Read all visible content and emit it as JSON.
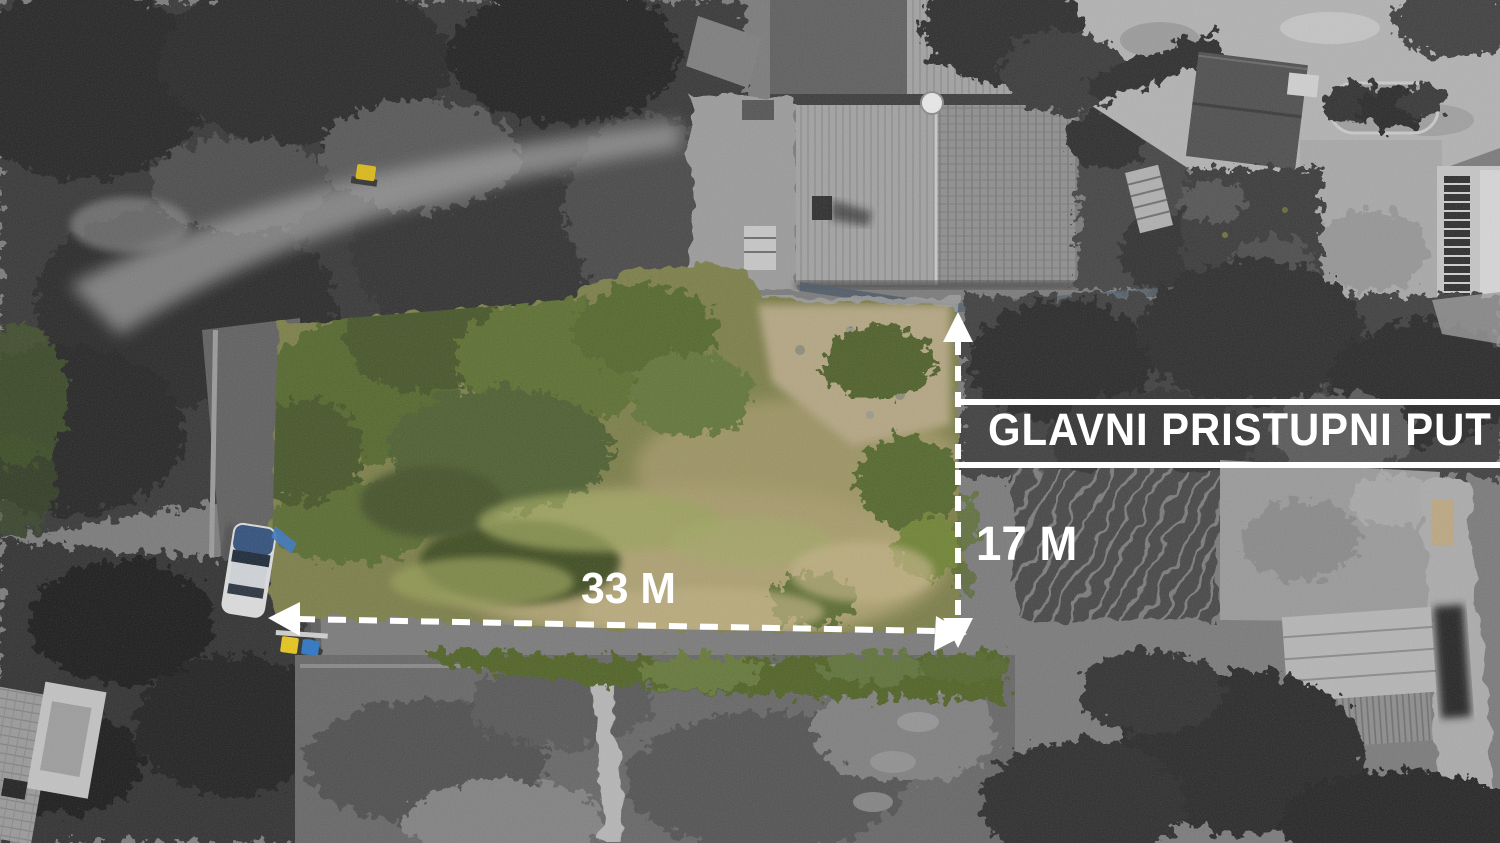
{
  "annotations": {
    "road_label": "GLAVNI PRISTUPNI PUT",
    "width_label": "33 M",
    "depth_label": "17 M"
  },
  "measurements": {
    "plot_width_m": 33,
    "plot_depth_m": 17
  },
  "icons": {
    "arrow_up": "triangle-up",
    "arrow_down": "triangle-down",
    "arrow_left": "triangle-left",
    "arrow_right": "triangle-right"
  },
  "colors": {
    "annotation_white": "#ffffff",
    "plot_green": "#7b7f4a",
    "plot_tan": "#b3a577",
    "hedge_green": "#516328",
    "car_blue": "#33517c",
    "bin_yellow": "#e6c51d",
    "bin_blue": "#2f76c4",
    "background_gray": "#7b7b7b"
  }
}
